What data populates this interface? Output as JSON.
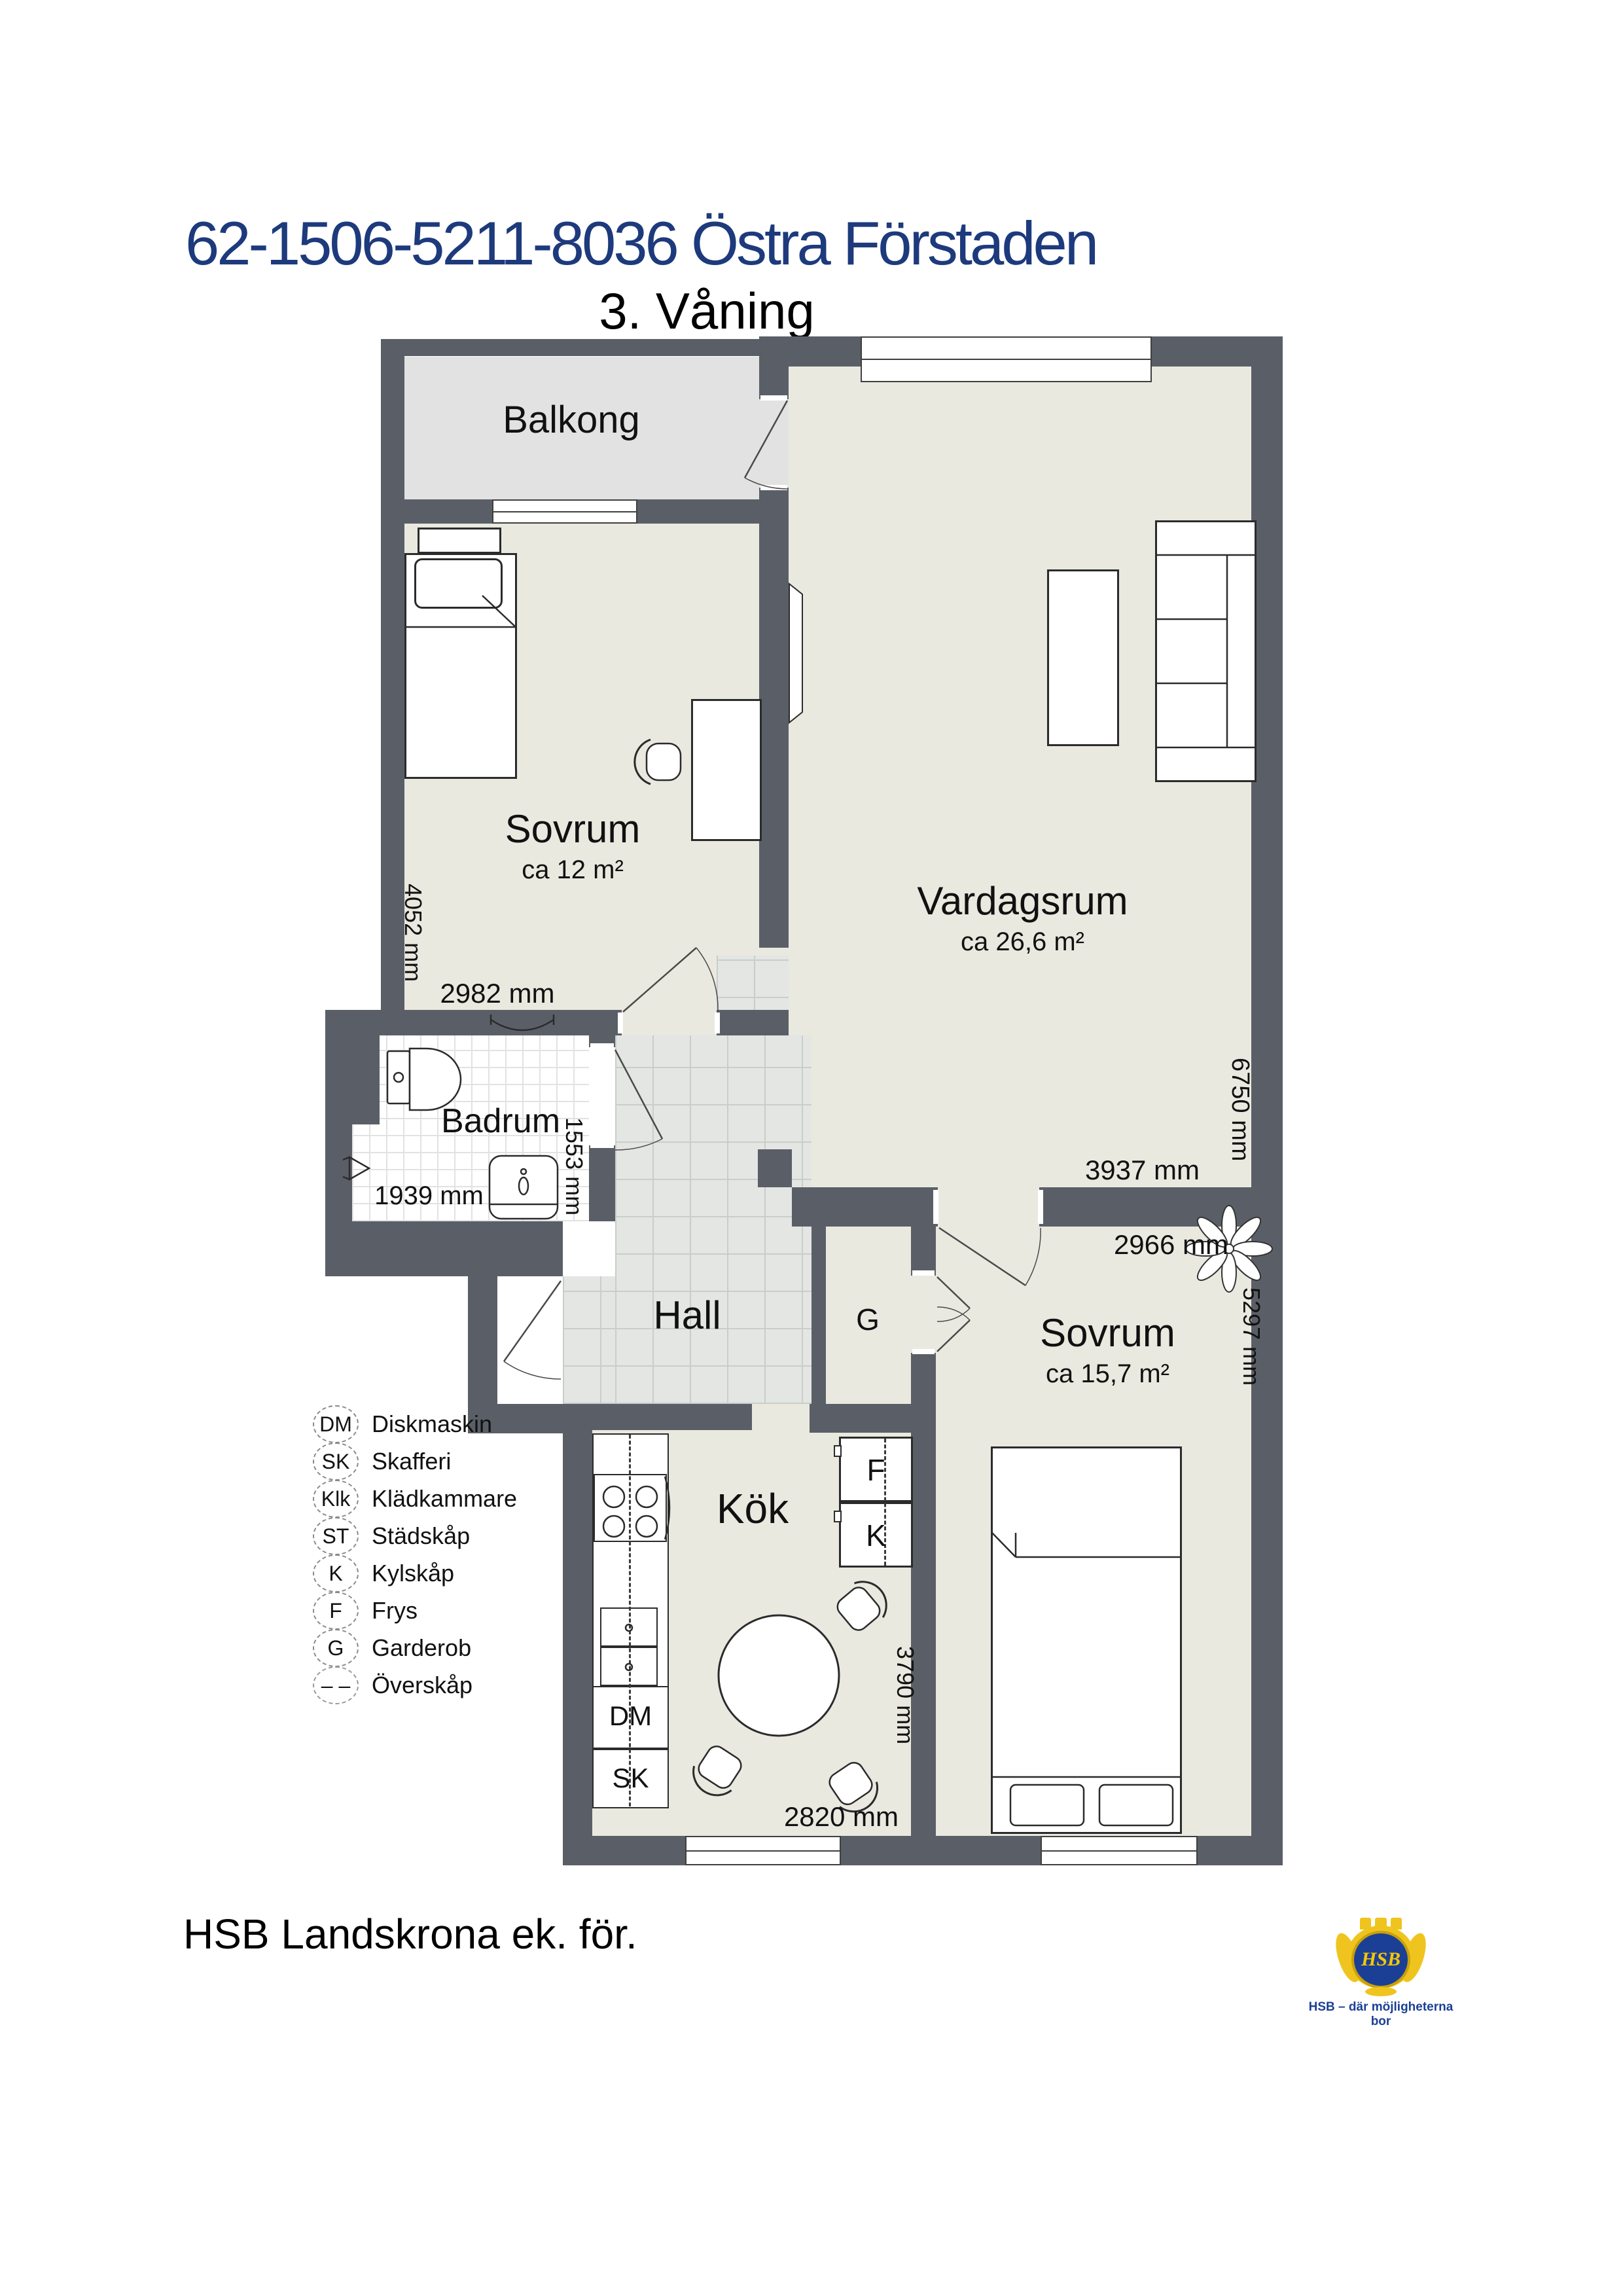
{
  "header": {
    "title": "62-1506-5211-8036 Östra Förstaden",
    "floor": "3. Våning"
  },
  "rooms": {
    "balkong": {
      "name": "Balkong"
    },
    "sovrum1": {
      "name": "Sovrum",
      "area": "ca 12 m²",
      "dim_w": "2982 mm",
      "dim_h": "4052 mm"
    },
    "vardagsrum": {
      "name": "Vardagsrum",
      "area": "ca 26,6 m²",
      "dim_w": "3937 mm",
      "dim_h": "6750 mm"
    },
    "badrum": {
      "name": "Badrum",
      "dim_w": "1939 mm",
      "dim_h": "1553 mm"
    },
    "hall": {
      "name": "Hall"
    },
    "kok": {
      "name": "Kök",
      "dim_w": "2820 mm",
      "dim_h": "3790 mm"
    },
    "sovrum2": {
      "name": "Sovrum",
      "area": "ca 15,7 m²",
      "dim_w": "2966 mm",
      "dim_h": "5297 mm"
    }
  },
  "units": {
    "g": "G",
    "f": "F",
    "k": "K",
    "dm": "DM",
    "sk": "SK"
  },
  "legend": [
    {
      "abbr": "DM",
      "label": "Diskmaskin"
    },
    {
      "abbr": "SK",
      "label": "Skafferi"
    },
    {
      "abbr": "Klk",
      "label": "Klädkammare"
    },
    {
      "abbr": "ST",
      "label": "Städskåp"
    },
    {
      "abbr": "K",
      "label": "Kylskåp"
    },
    {
      "abbr": "F",
      "label": "Frys"
    },
    {
      "abbr": "G",
      "label": "Garderob"
    },
    {
      "abbr": "– –",
      "label": "Överskåp"
    }
  ],
  "footer": {
    "text": "HSB Landskrona ek. för."
  },
  "logo": {
    "monogram": "HSB",
    "tagline": "HSB – där möjligheterna bor"
  },
  "colors": {
    "wall": "#5a5f67",
    "floor": "#eae9e0",
    "balcony": "#e2e2e2",
    "title": "#1d3a7c"
  }
}
